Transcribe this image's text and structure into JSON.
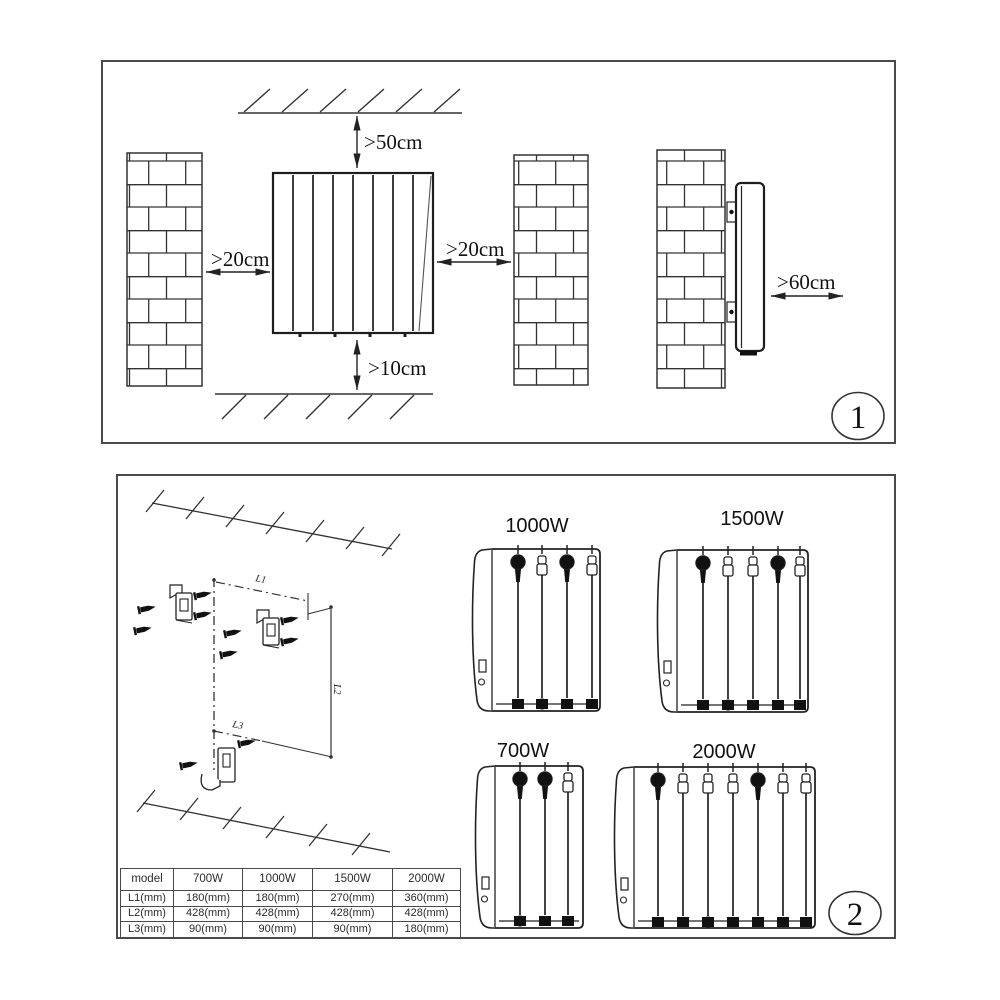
{
  "panel1": {
    "figure_number": "1",
    "labels": {
      "ceiling_clearance": ">50cm",
      "left_clearance": ">20cm",
      "right_clearance": ">20cm",
      "floor_clearance": ">10cm",
      "front_clearance": ">60cm"
    }
  },
  "panel2": {
    "figure_number": "2",
    "dim_labels": {
      "l1": "L1",
      "l2": "L2",
      "l3": "L3"
    },
    "model_labels": {
      "top_left": "1000W",
      "top_right": "1500W",
      "bottom_left": "700W",
      "bottom_right": "2000W"
    },
    "table": {
      "headers": [
        "model",
        "700W",
        "1000W",
        "1500W",
        "2000W"
      ],
      "rows": [
        [
          "L1(mm)",
          "180(mm)",
          "180(mm)",
          "270(mm)",
          "360(mm)"
        ],
        [
          "L2(mm)",
          "428(mm)",
          "428(mm)",
          "428(mm)",
          "428(mm)"
        ],
        [
          "L3(mm)",
          "90(mm)",
          "90(mm)",
          "90(mm)",
          "180(mm)"
        ]
      ]
    }
  }
}
